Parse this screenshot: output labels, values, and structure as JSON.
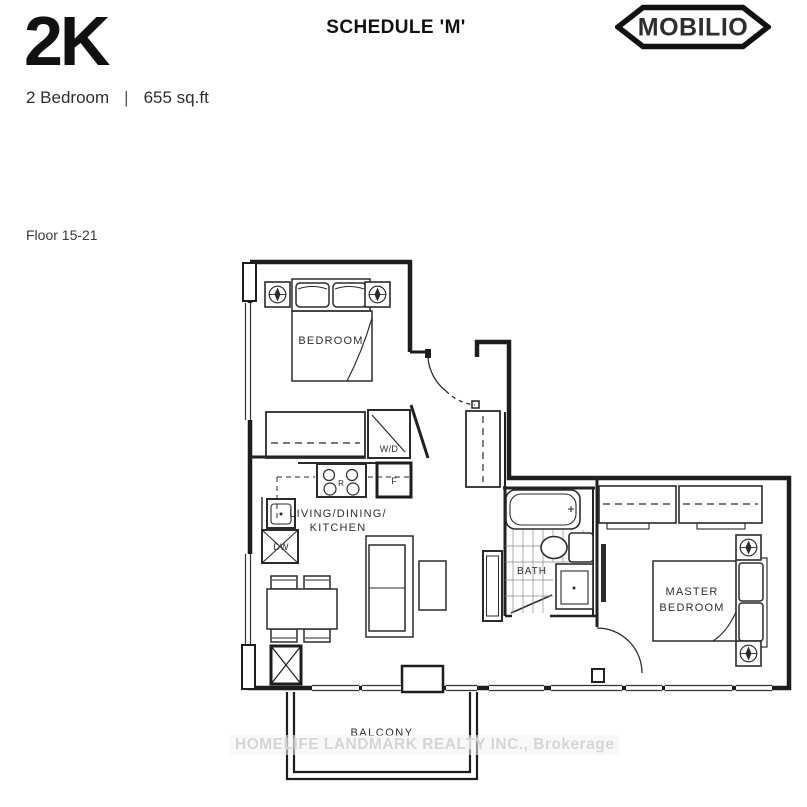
{
  "header": {
    "unit_code": "2K",
    "schedule": "SCHEDULE 'M'",
    "brand": "MOBILIO",
    "unit_type": "2 Bedroom",
    "separator": "|",
    "area": "655 sq.ft",
    "floors": "Floor 15-21"
  },
  "plan": {
    "rooms": {
      "bedroom": "BEDROOM",
      "living_line1": "LIVING/DINING/",
      "living_line2": "KITCHEN",
      "bath": "BATH",
      "master_line1": "MASTER",
      "master_line2": "BEDROOM",
      "balcony": "BALCONY"
    },
    "appliances": {
      "washer_dryer": "W/D",
      "dishwasher": "DW",
      "fridge": "F",
      "range": "R"
    }
  },
  "watermark": "HOMELIFE LANDMARK REALTY INC., Brokerage",
  "colors": {
    "ink": "#1c1c1c",
    "plan_line": "#2b2b2b",
    "watermark_text": "#d4d4d4"
  }
}
